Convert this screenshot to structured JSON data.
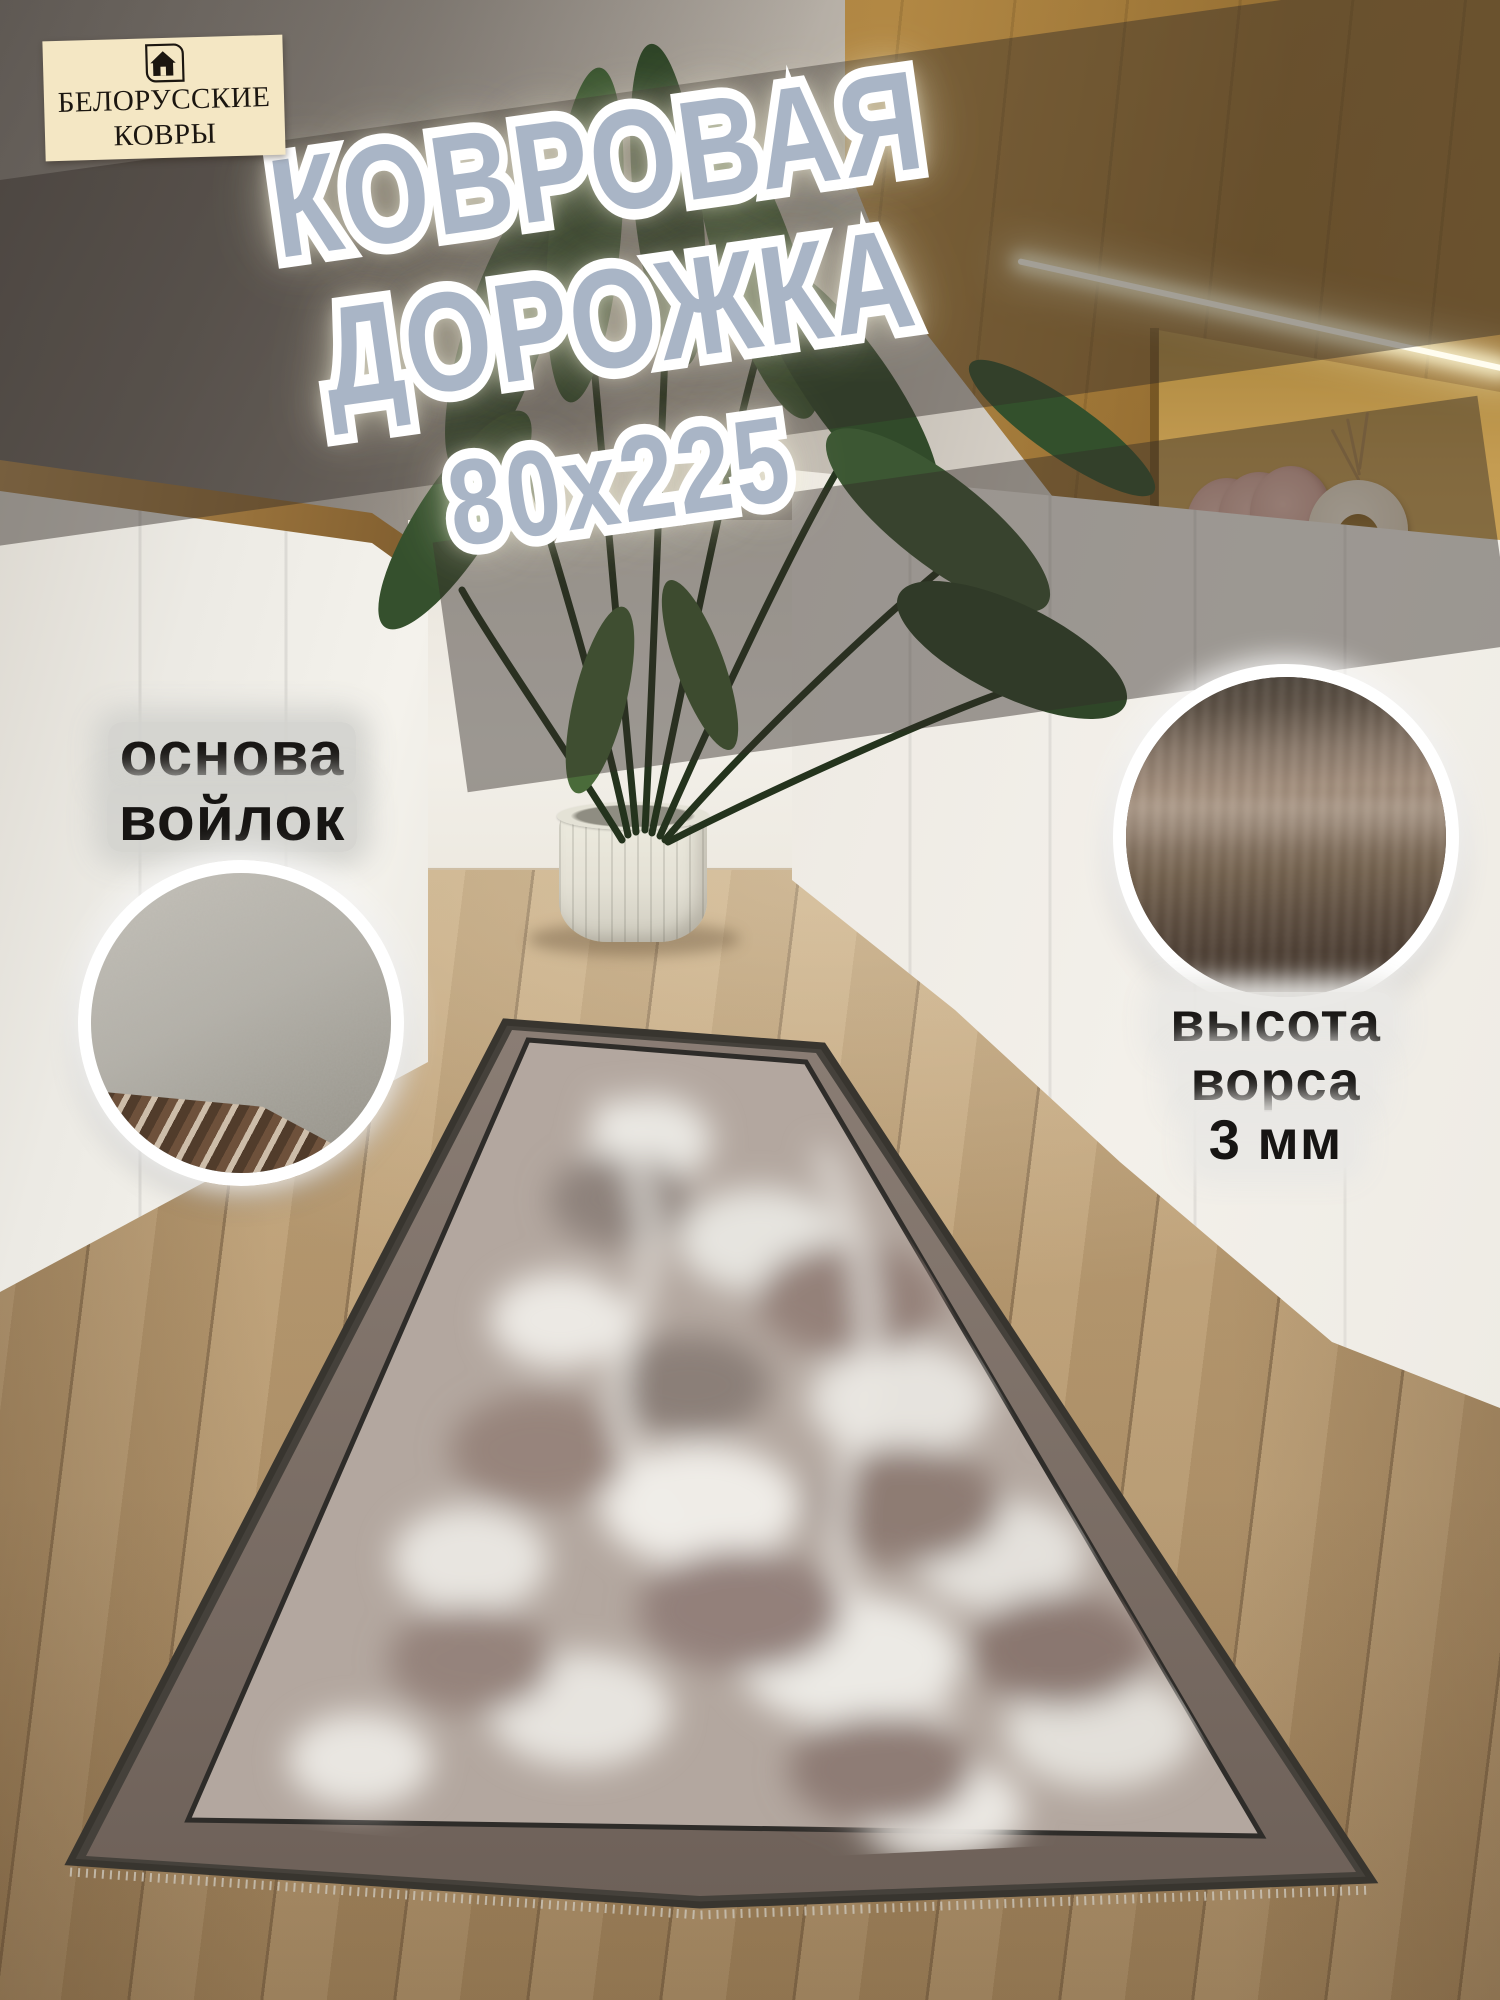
{
  "brand": {
    "line1": "БЕЛОРУССКИЕ",
    "line2": "КОВРЫ",
    "icon": "house-icon"
  },
  "title": {
    "line1": "КОВРОВАЯ",
    "line2": "ДОРОЖКА",
    "size": "80x225"
  },
  "callouts": {
    "backing": {
      "line1": "основа",
      "line2": "войлок"
    },
    "pile": {
      "line1": "высота",
      "line2": "ворса",
      "line3": "3 мм"
    }
  },
  "colors": {
    "title_fill": "#a9b5c6",
    "title_outline": "#ffffff",
    "label_text": "#171513",
    "label_glow": "#d3d2ce",
    "logo_bg": "#f4e7c4",
    "logo_text": "#1b1610",
    "band_shadow": "rgba(50,45,39,0.45)",
    "carpet_border": "#7c6f66",
    "carpet_field": "#b3a79f",
    "carpet_edge": "#38352f",
    "floor_wood": "#b89a70",
    "oak_cabinet": "#a87f3e"
  }
}
